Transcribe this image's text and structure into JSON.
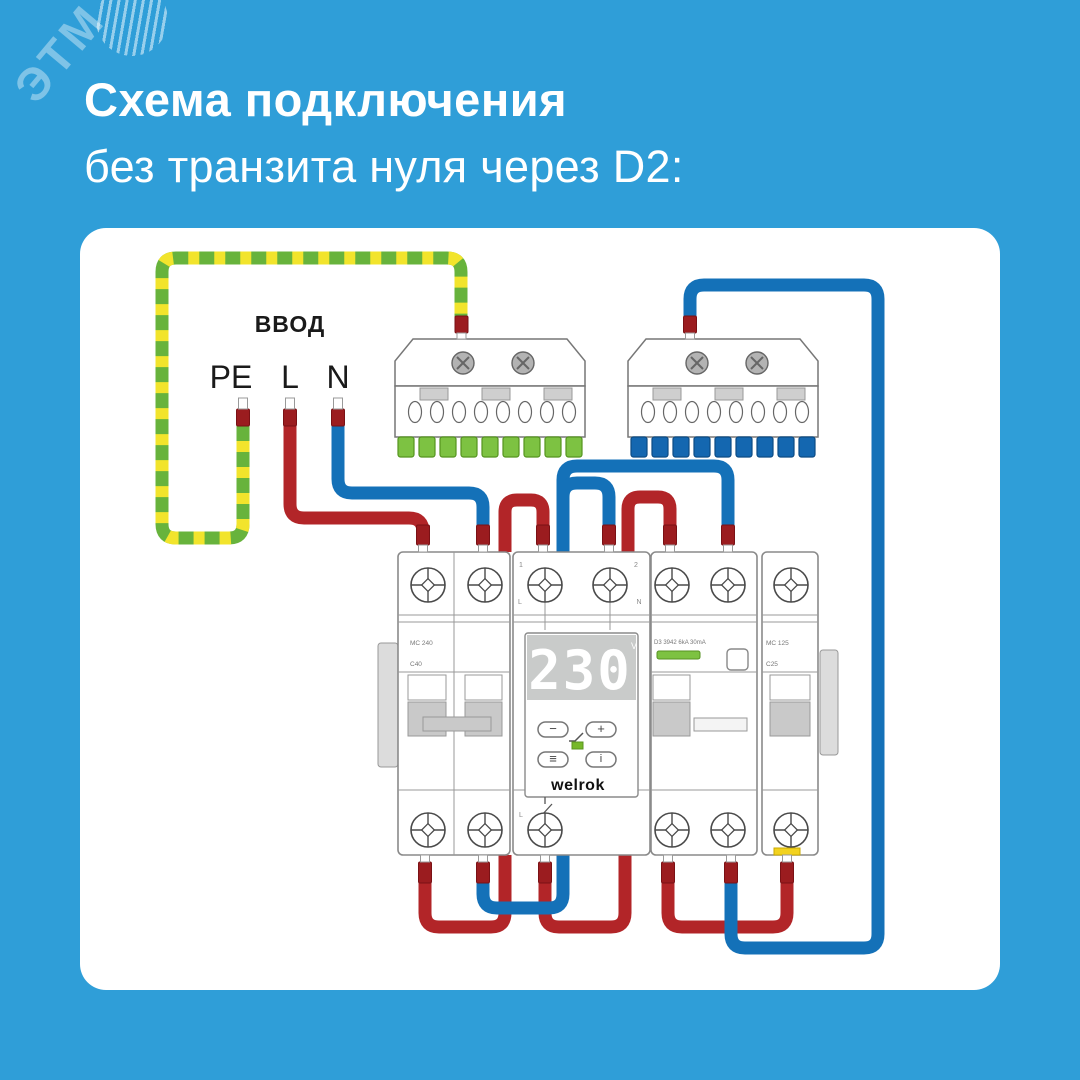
{
  "header": {
    "title": "Схема подключения",
    "subtitle": "без транзита нуля через D2:"
  },
  "watermark": {
    "text": "ЭТМ"
  },
  "diagram": {
    "input": {
      "label": "ВВОД",
      "terminal_pe": "PE",
      "terminal_l": "L",
      "terminal_n": "N"
    },
    "main_breaker": {
      "model": "MC 240",
      "rating": "C40"
    },
    "relay": {
      "display_value": "230",
      "display_unit": "V",
      "brand": "welrok",
      "button_minus": "−",
      "button_plus": "+",
      "button_menu": "≡",
      "button_info": "i",
      "mark_terminal_1": "1",
      "mark_terminal_2": "2",
      "mark_l_in": "L",
      "mark_n_in": "N",
      "mark_l_out": "L"
    },
    "rcd": {
      "model": "D3 3942 6kA 30mA"
    },
    "load_breaker": {
      "model": "MC 125",
      "rating": "C25"
    }
  },
  "colors": {
    "background": "#2F9ED8",
    "panel": "#FFFFFF",
    "wire_red": "#B22528",
    "wire_blue": "#1471B8",
    "pe_green": "#67B33C",
    "pe_yellow": "#F2E42C",
    "ferrule_red": "#9B1C1F",
    "busbar_pe_clip": "#7DC242",
    "busbar_n_clip": "#1467B0",
    "led_green": "#76B82A",
    "terminal_marker_yellow": "#F2D21F"
  }
}
